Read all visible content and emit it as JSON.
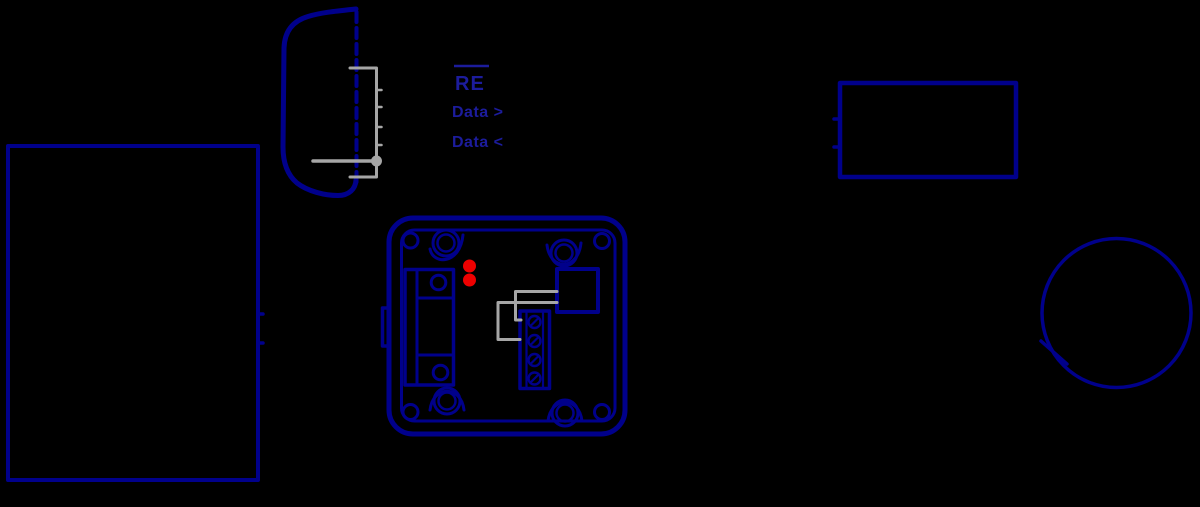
{
  "canvas": {
    "width": 1200,
    "height": 507,
    "background": "#000000"
  },
  "colors": {
    "line_navy": "#00008B",
    "label_blue": "#1c1c9c",
    "wire_gray": "#a6a6a6",
    "led_red": "#ee0000"
  },
  "labels": {
    "re": "RE",
    "data_out": "Data >",
    "data_in": "Data <"
  },
  "icons": {
    "db9_connector": "d-sub-connector-shell-side-view",
    "hidden_edge": "dashed-hidden-line",
    "pin_bracket": "gray-pin-row-bracket-with-tap-dot",
    "left_rectangle": "large-device-outline",
    "power_rectangle": "small-device-outline-with-wire-stubs",
    "sensor_circle": "round-device-outline-with-connection-tick",
    "converter_box": "junction-box-with-screw-bosses-relay-terminal-block-and-two-red-leds"
  }
}
